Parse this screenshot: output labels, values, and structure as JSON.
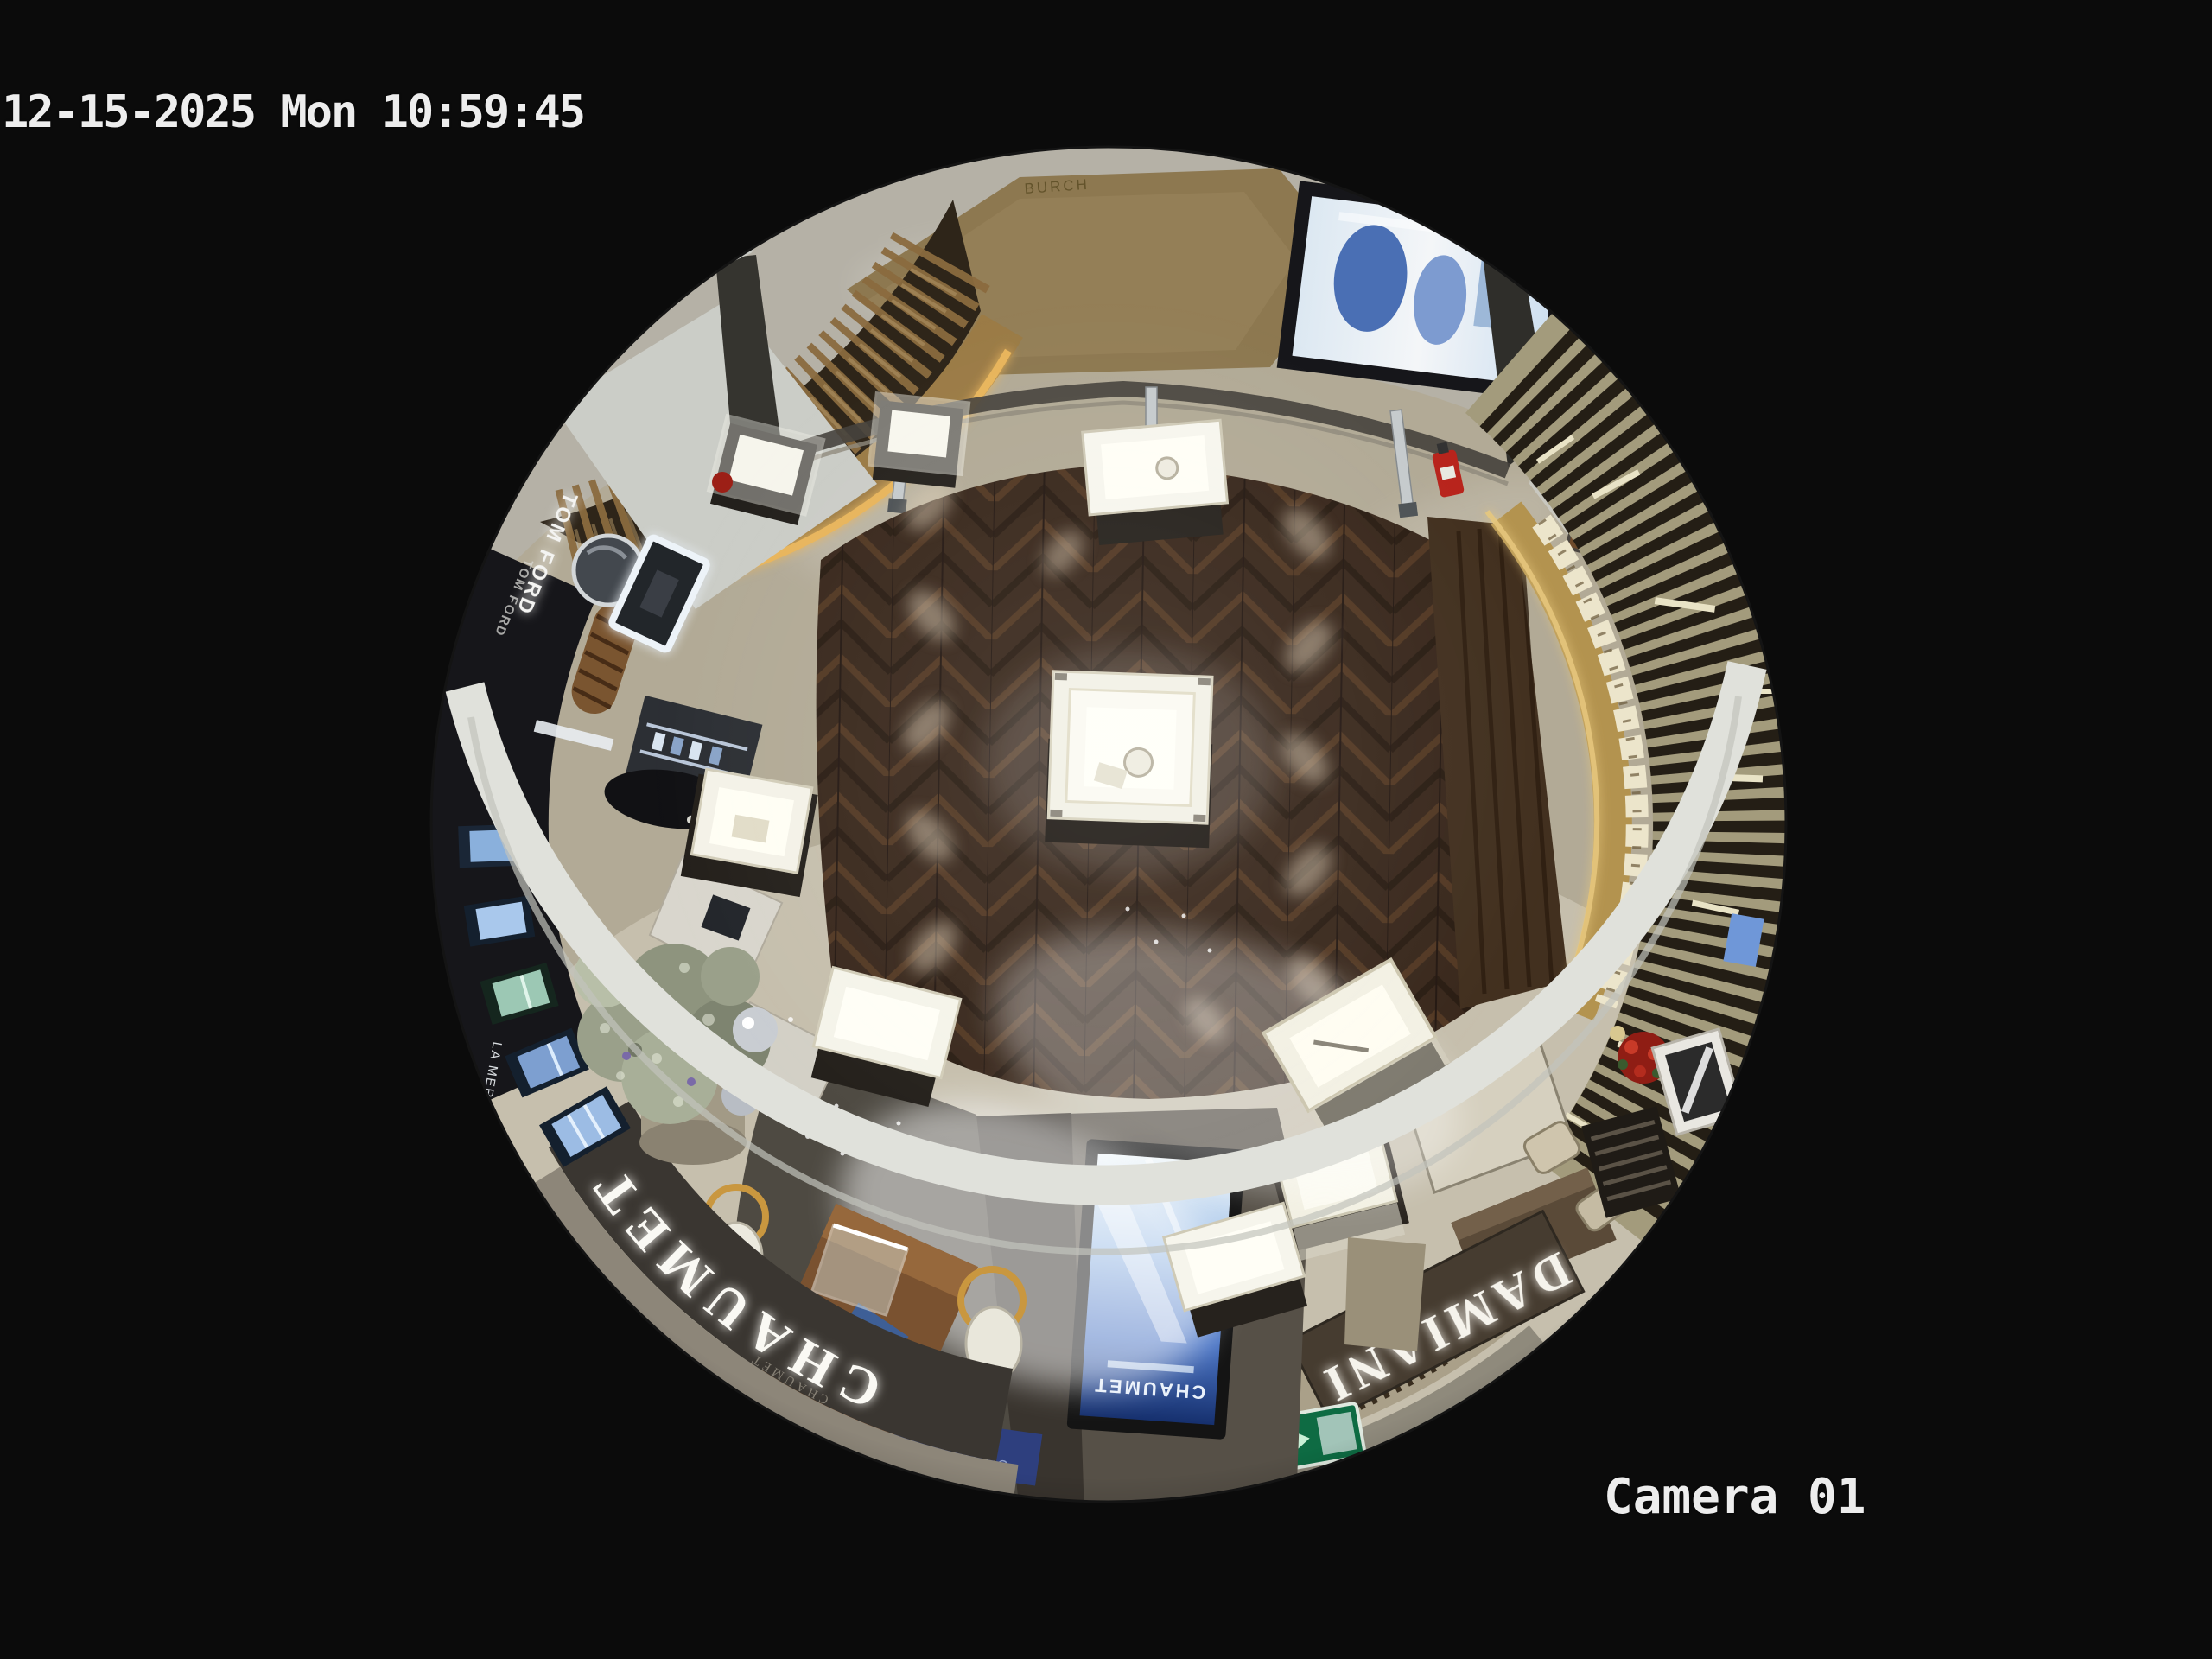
{
  "osd": {
    "timestamp": "12-15-2025 Mon 10:59:45",
    "camera_label": "Camera 01"
  },
  "signage": {
    "tom_ford": "TOM FORD",
    "tom_ford_secondary": "TOM FORD",
    "burch": "BURCH",
    "la_mer": "LA MER",
    "chaumet_fascia": "CHAUMET",
    "chaumet_fascia_small": "CHAUMET",
    "chaumet_kiosk_screen": "CHAUMET",
    "chaumet_blue_panel": "CHAUMET",
    "damiani_fascia": "DAMIANI",
    "damiani_board": "DAMIANI",
    "exit_sign": "出口 EXIT"
  },
  "colors": {
    "background": "#0b0b0b",
    "osd_text": "#ededed",
    "walkway_stone": "#b2aa96",
    "herringbone_floor": "#39281c",
    "marble_corridor": "#b5b1a6",
    "fascia_dark": "#3a3631",
    "brand_glow": "#faf9f4",
    "gold_trim": "#c7a865",
    "kiosk_screen_blue": "#4a74c4",
    "exit_sign_green": "#0e6b43",
    "accent_red": "#a8251c"
  }
}
